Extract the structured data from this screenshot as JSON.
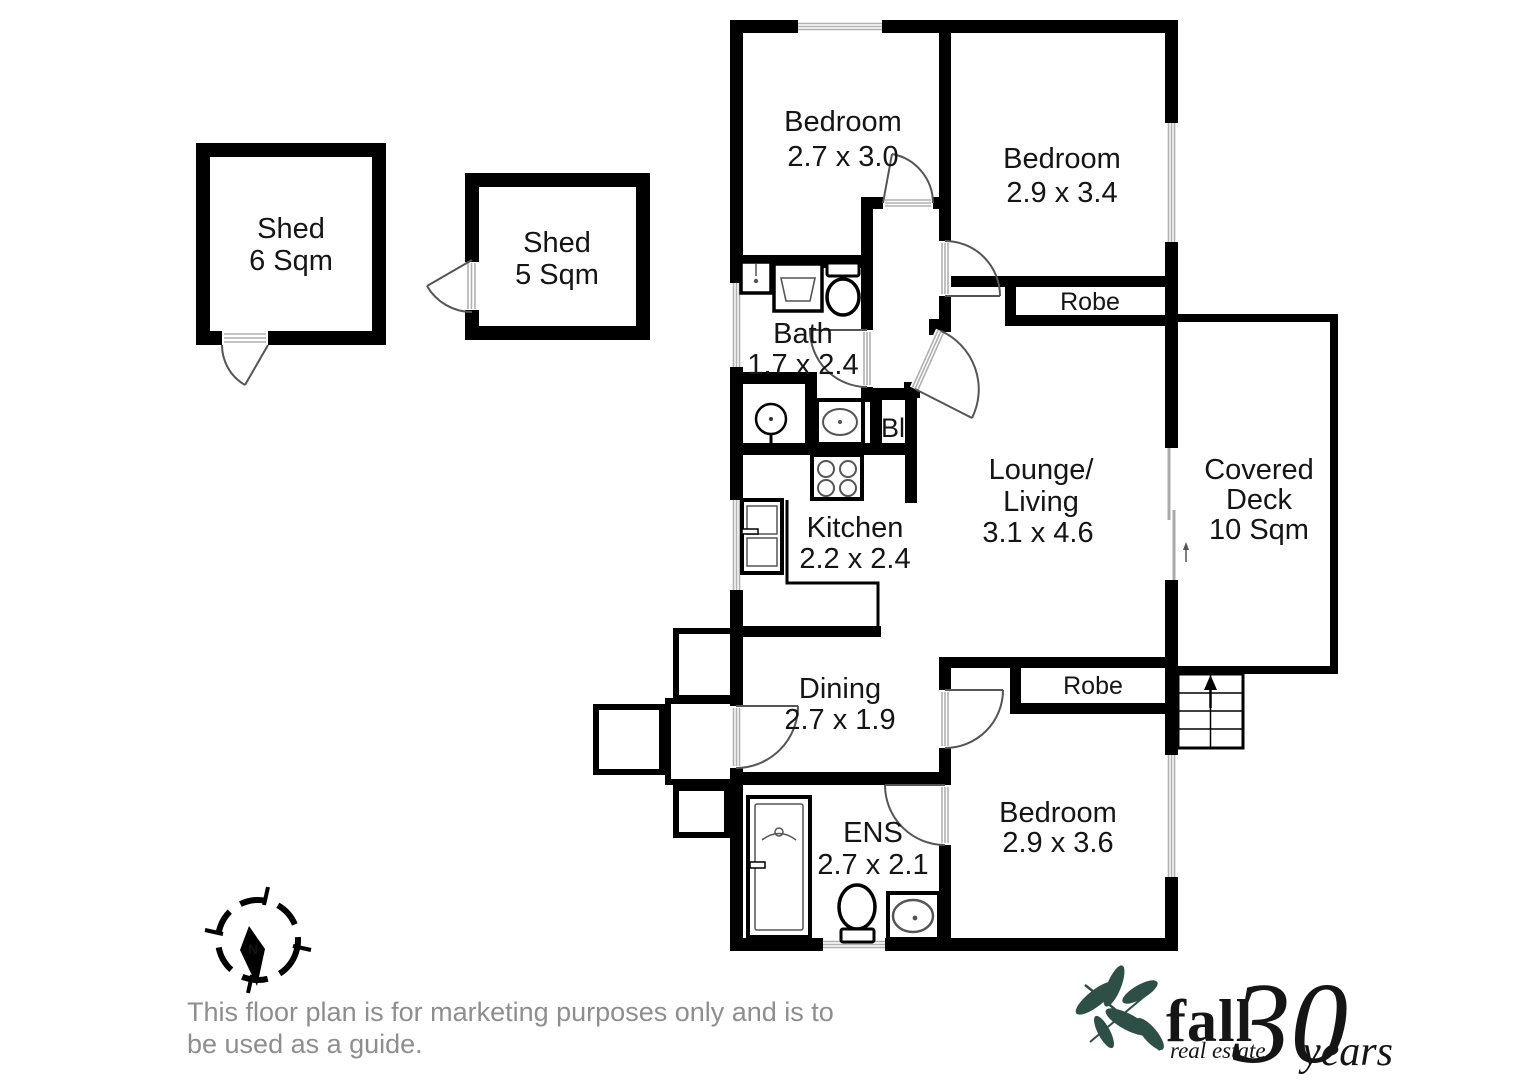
{
  "plan": {
    "rooms": {
      "bedroom_top_left": {
        "name": "Bedroom",
        "dims": "2.7 x 3.0"
      },
      "bedroom_top_right": {
        "name": "Bedroom",
        "dims": "2.9 x 3.4"
      },
      "bath": {
        "name": "Bath",
        "dims": "1.7 x 2.4"
      },
      "robe_top": {
        "name": "Robe"
      },
      "lounge": {
        "name_line1": "Lounge/",
        "name_line2": "Living",
        "dims": "3.1 x 4.6"
      },
      "covered_deck": {
        "name_line1": "Covered",
        "name_line2": "Deck",
        "dims": "10 Sqm"
      },
      "kitchen": {
        "name": "Kitchen",
        "dims": "2.2 x 2.4"
      },
      "dining": {
        "name": "Dining",
        "dims": "2.7 x 1.9"
      },
      "robe_bottom": {
        "name": "Robe"
      },
      "bedroom_bottom": {
        "name": "Bedroom",
        "dims": "2.9 x 3.6"
      },
      "ensuite": {
        "name": "ENS",
        "dims": "2.7 x 2.1"
      },
      "built_in": {
        "name": "Bl"
      },
      "shed_large": {
        "name": "Shed",
        "dims": "6 Sqm"
      },
      "shed_small": {
        "name": "Shed",
        "dims": "5 Sqm"
      }
    },
    "compass": {
      "north_label": "N"
    }
  },
  "disclaimer": {
    "line1": "This floor plan is for marketing purposes only and is to",
    "line2": "be used as a guide."
  },
  "logo": {
    "brand": "fall",
    "tagline": "real estate",
    "anniversary_number": "30",
    "anniversary_word": "years",
    "color_dark": "#2d4f46",
    "color_light": "#b9cfc6"
  }
}
